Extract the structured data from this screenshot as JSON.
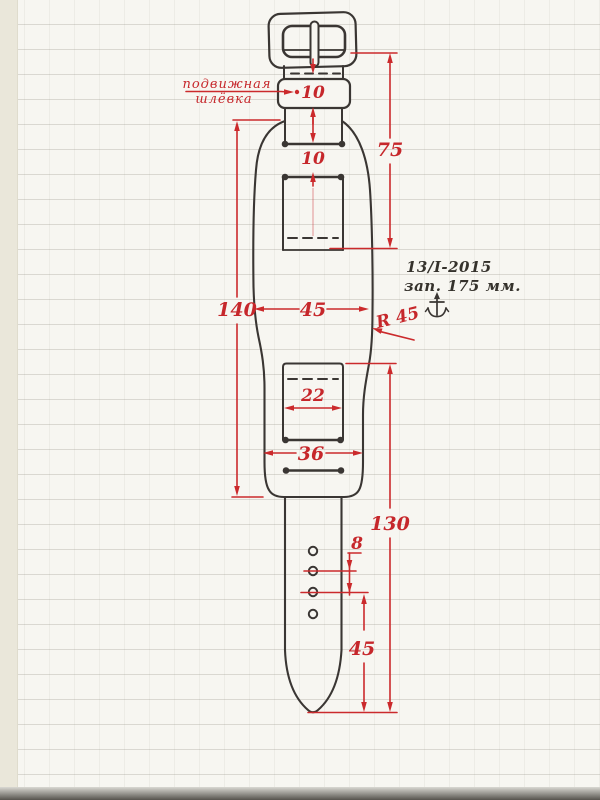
{
  "title": "watch strap pattern technical drawing",
  "annotations": {
    "loop_label_line1": "подвижная",
    "loop_label_line2": "шлёвка",
    "note_date": "13/I-2015",
    "note_length": "зап. 175 мм.",
    "radius_label": "R 45"
  },
  "dimensions": {
    "loop_width": "10",
    "slot_gap": "10",
    "buckle_to_slot": "75",
    "cuff_length": "140",
    "cuff_width": "45",
    "strap_width": "22",
    "cuff_bottom_width": "36",
    "strap_length": "130",
    "hole_spacing": "8",
    "tip_to_hole": "45"
  },
  "colors": {
    "ink": "#3a3633",
    "dimension_red": "#cb2a2c",
    "paper": "#f7f6f1",
    "margin_strip": "#eae7da",
    "rule_line": "#96948a",
    "bottom_edge": "#56534d"
  }
}
